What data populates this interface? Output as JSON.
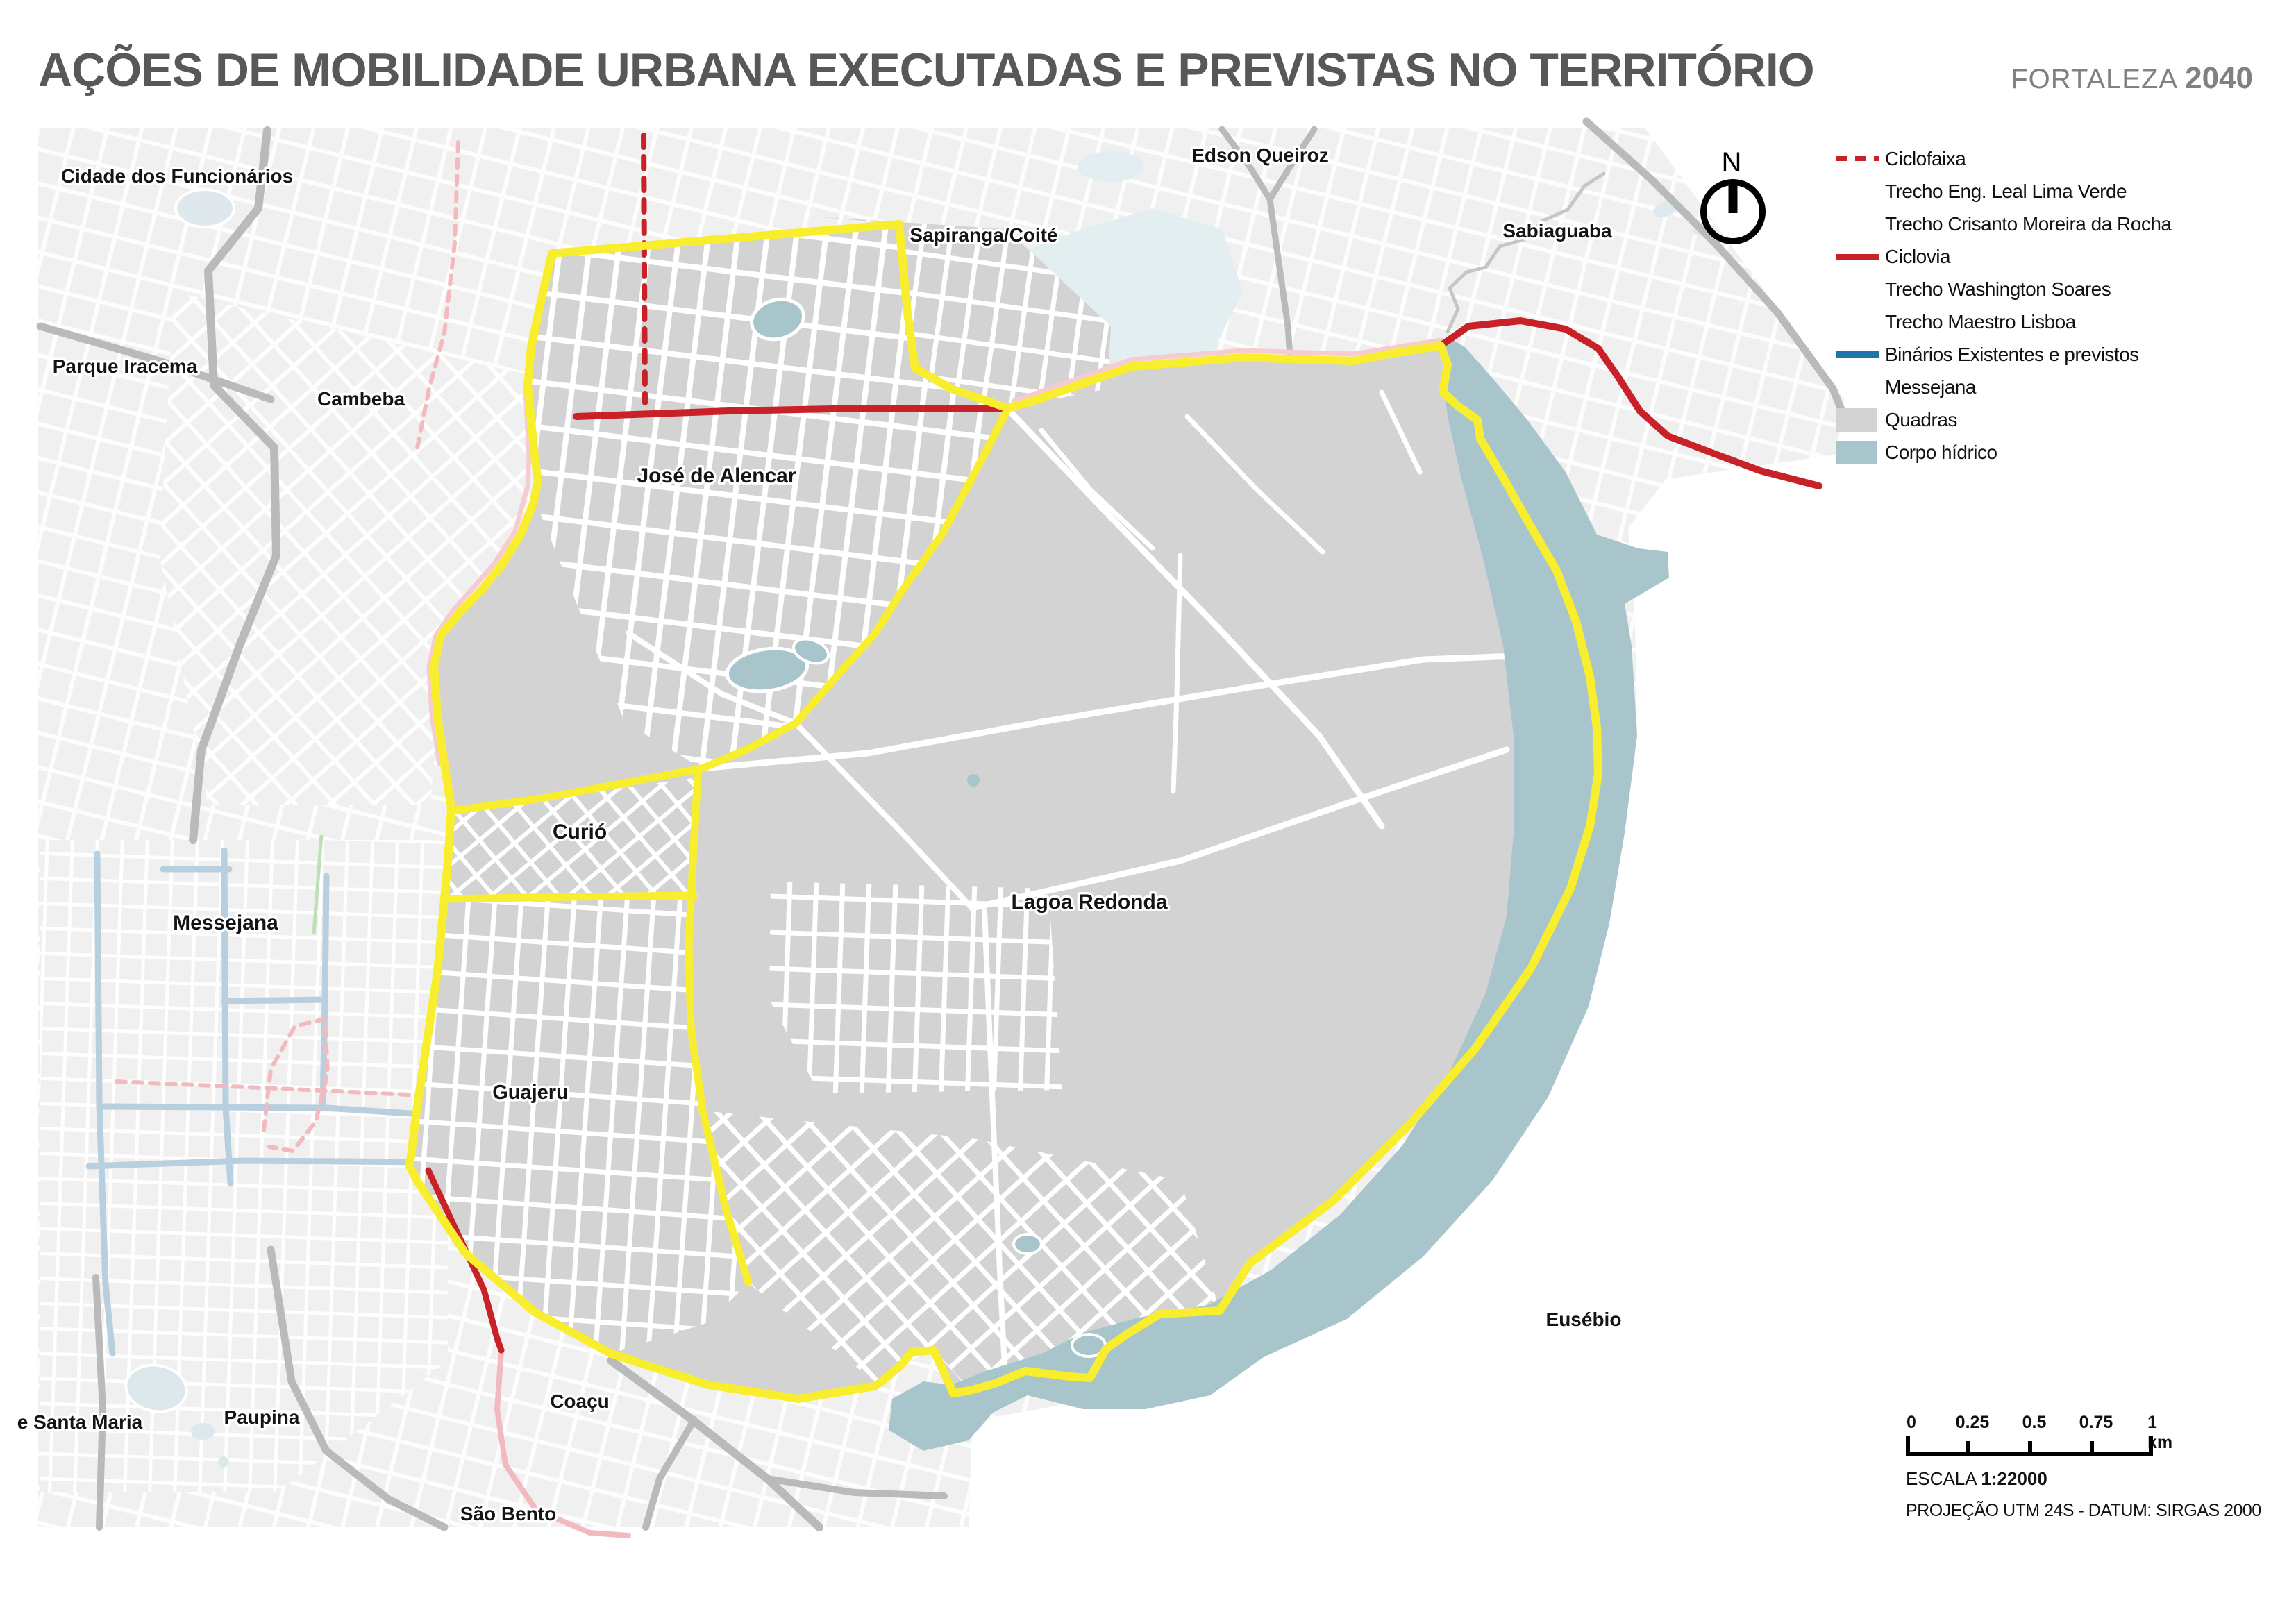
{
  "title": "AÇÕES DE MOBILIDADE URBANA EXECUTADAS E PREVISTAS NO TERRITÓRIO",
  "brand": {
    "name": "FORTALEZA",
    "year": "2040"
  },
  "legend": {
    "items": [
      {
        "label": "Ciclofaixa",
        "marker": "red-dashed-line"
      },
      {
        "label": "Trecho Eng. Leal Lima Verde",
        "marker": "none"
      },
      {
        "label": "Trecho Crisanto Moreira da Rocha",
        "marker": "none"
      },
      {
        "label": "Ciclovia",
        "marker": "red-solid-line"
      },
      {
        "label": "Trecho Washington Soares",
        "marker": "none"
      },
      {
        "label": "Trecho Maestro Lisboa",
        "marker": "none"
      },
      {
        "label": "Binários Existentes e previstos",
        "marker": "blue-solid-line"
      },
      {
        "label": "Messejana",
        "marker": "none"
      },
      {
        "label": "Quadras",
        "marker": "gray-square"
      },
      {
        "label": "Corpo hídrico",
        "marker": "water-square"
      }
    ]
  },
  "map": {
    "north_label": "N",
    "labels": [
      {
        "text": "Cidade dos Funcionários"
      },
      {
        "text": "Parque Iracema"
      },
      {
        "text": "Cambeba"
      },
      {
        "text": "Sapiranga/Coité"
      },
      {
        "text": "Edson Queiroz"
      },
      {
        "text": "Sabiaguaba"
      },
      {
        "text": "José de Alencar"
      },
      {
        "text": "Curió"
      },
      {
        "text": "Messejana"
      },
      {
        "text": "Lagoa Redonda"
      },
      {
        "text": "Guajeru"
      },
      {
        "text": "Eusébio"
      },
      {
        "text": "Paupina"
      },
      {
        "text": "e Santa Maria"
      },
      {
        "text": "Coaçu"
      },
      {
        "text": "São Bento"
      }
    ]
  },
  "scale": {
    "tick_0": "0",
    "tick_025": "0.25",
    "tick_05": "0.5",
    "tick_075": "0.75",
    "tick_1": "1 km",
    "escala_label": "ESCALA",
    "escala_value": "1:22000",
    "projection": "PROJEÇÃO UTM 24S - DATUM: SIRGAS 2000"
  },
  "colors": {
    "boundary_yellow": "#f9ee2e",
    "cicloroute_red": "#c92128",
    "binarios_blue": "#1f74ad",
    "quadras_gray": "#d3d3d3",
    "water": "#a9c5cc",
    "outside_gray": "#f0f0f0",
    "title_gray": "#58585a"
  }
}
